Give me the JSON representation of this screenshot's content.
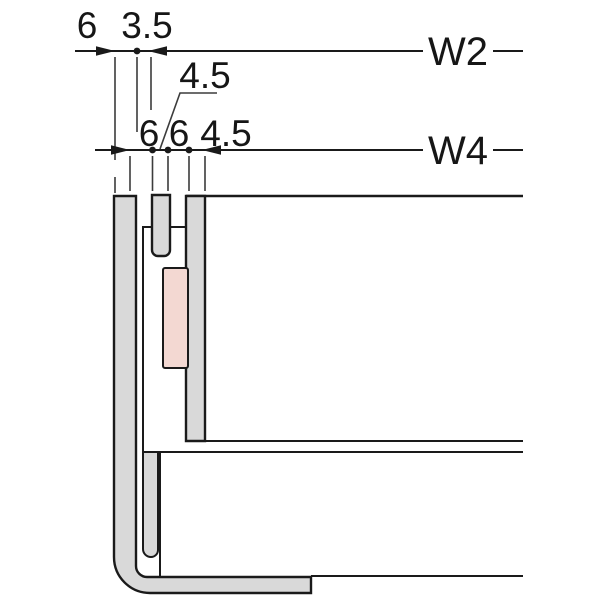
{
  "title": "frame corner section detail drawing",
  "dimensions": {
    "w2": {
      "label": "W2",
      "seg1": "6",
      "seg2": "3.5"
    },
    "w4": {
      "label": "W4",
      "seg1": "6",
      "seg2": "4.5",
      "seg3": "6",
      "seg4": "4.5"
    }
  },
  "colors": {
    "line": "#1a1a1a",
    "extension_line": "#3c3c3c",
    "bar_fill": "#d9d9d9",
    "pink_fill": "#f3d8d2",
    "background": "#ffffff",
    "text": "#161616"
  }
}
